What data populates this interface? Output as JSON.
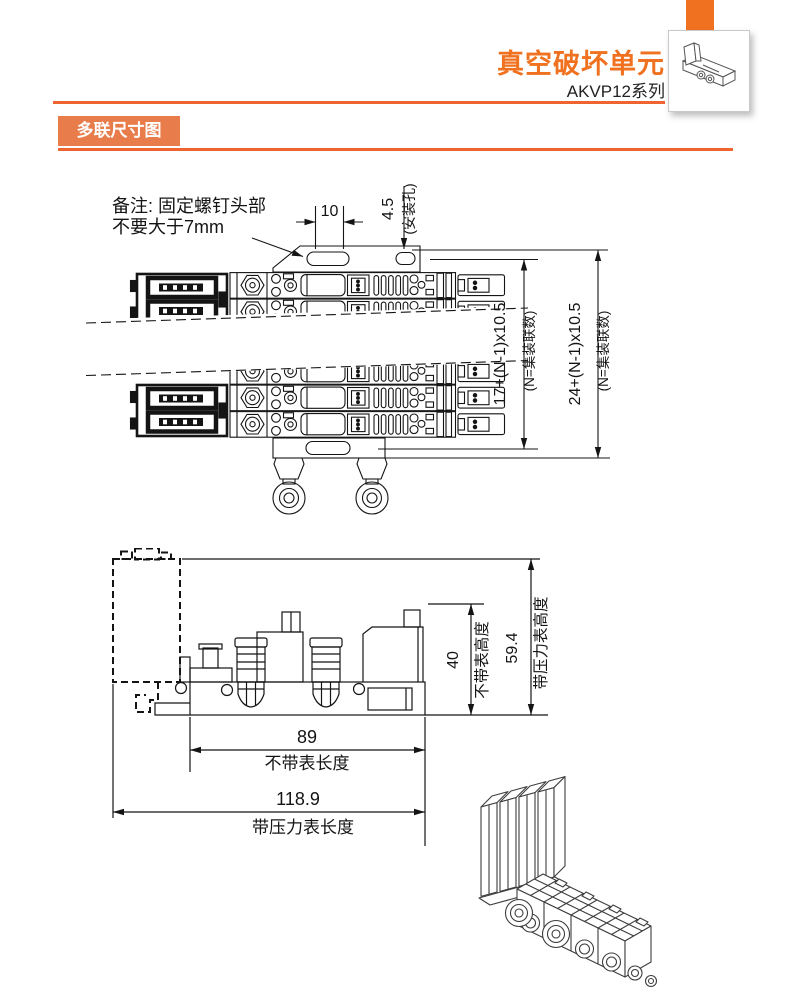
{
  "header": {
    "title": "真空破坏单元",
    "series": "AKVP12系列"
  },
  "section": {
    "label": "多联尺寸图"
  },
  "colors": {
    "accent_orange": "#F0711F",
    "label_orange": "#E87C4A",
    "rule_orange": "#EE6532",
    "drawing_line": "#141414"
  },
  "top_view": {
    "note_line1": "备注: 固定螺钉头部",
    "note_line2": "不要大于7mm",
    "dim_slot_width": "10",
    "dim_mount_hole": "4.5",
    "dim_mount_hole_label": "(安装孔)",
    "dim_pitch_inner": "17+(N-1)x10.5",
    "dim_pitch_inner_note": "(N=集装联数)",
    "dim_pitch_outer": "24+(N-1)x10.5",
    "dim_pitch_outer_note": "(N=集装联数)"
  },
  "side_view": {
    "dim_height_no_gauge": "40",
    "dim_height_no_gauge_label": "不带表高度",
    "dim_height_with_gauge": "59.4",
    "dim_height_with_gauge_label": "带压力表高度",
    "dim_length_no_gauge": "89",
    "dim_length_no_gauge_label": "不带表长度",
    "dim_length_with_gauge": "118.9",
    "dim_length_with_gauge_label": "带压力表长度"
  }
}
